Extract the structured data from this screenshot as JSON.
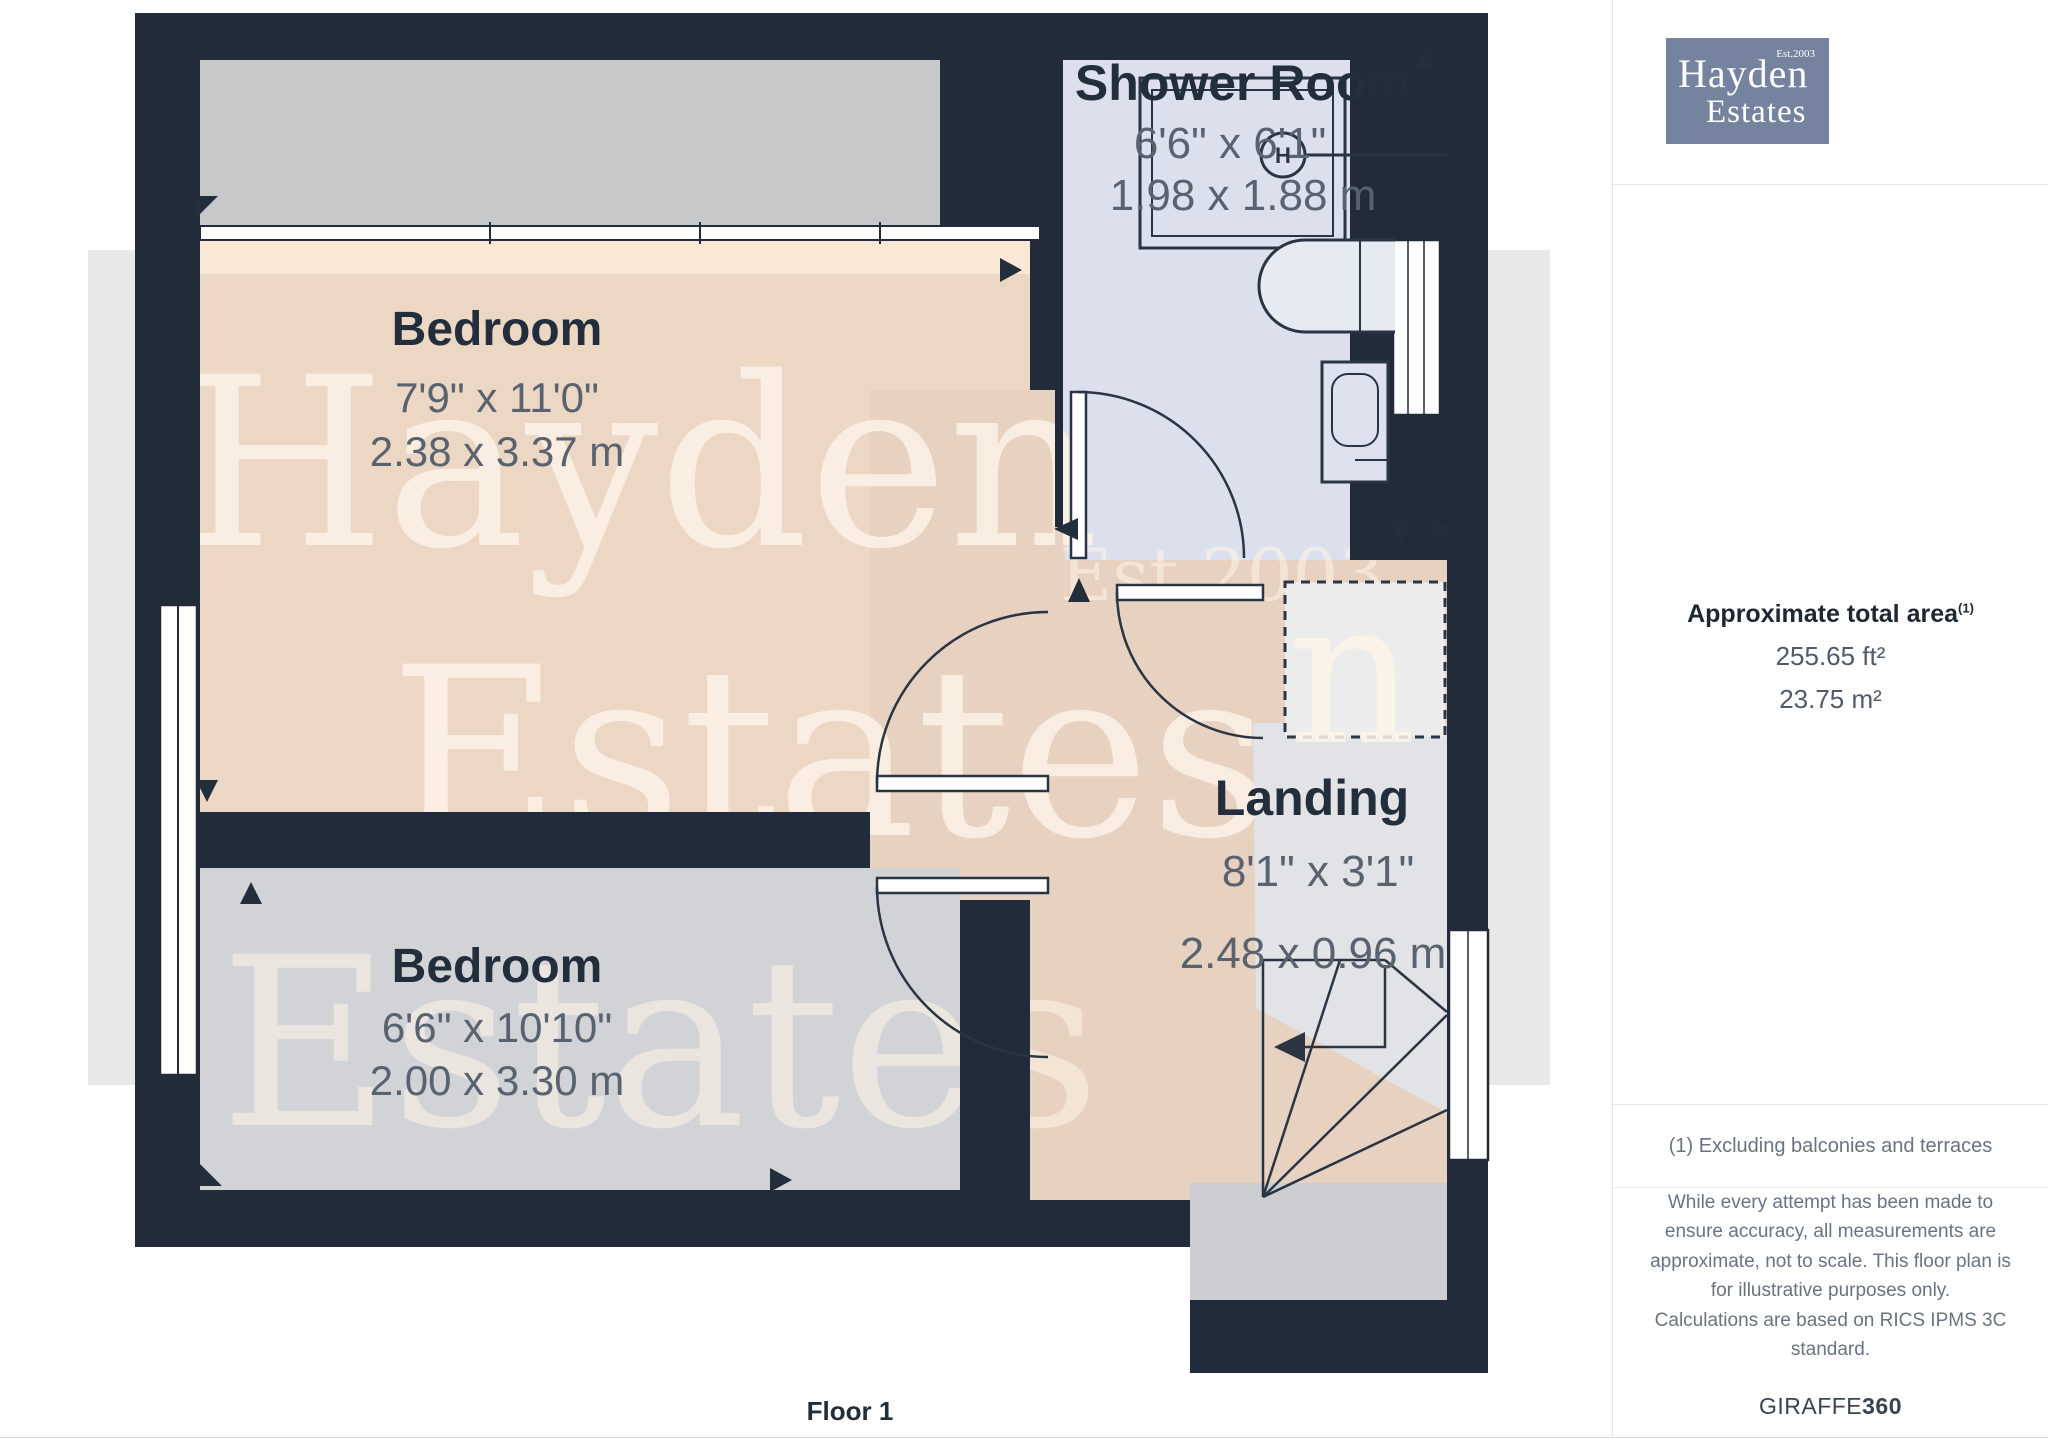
{
  "floor": {
    "label": "Floor 1"
  },
  "rooms": {
    "bedroom1": {
      "name": "Bedroom",
      "imperial": "7'9\" x 11'0\"",
      "metric": "2.38 x 3.37 m"
    },
    "bedroom2": {
      "name": "Bedroom",
      "imperial": "6'6\" x 10'10\"",
      "metric": "2.00 x 3.30 m"
    },
    "shower": {
      "name": "Shower Room",
      "imperial": "6'6\" x 6'1\"",
      "metric": "1.98 x 1.88 m"
    },
    "landing": {
      "name": "Landing",
      "imperial": "8'1\" x 3'1\"",
      "metric": "2.48 x 0.96 m"
    }
  },
  "fixtures": {
    "boiler_symbol": "H"
  },
  "watermark": {
    "line1": "Hayden",
    "line2": "Estates",
    "line3": "Estates",
    "est": "Est.2003"
  },
  "logo": {
    "name1": "Hayden",
    "name2": "Estates",
    "est": "Est.2003"
  },
  "sidebar": {
    "area_title": "Approximate total area",
    "area_superscript": "(1)",
    "area_ft": "255.65 ft²",
    "area_m": "23.75 m²",
    "footnote": "(1) Excluding balconies and terraces",
    "disclaimer1": "While every attempt has been made to ensure accuracy, all measurements are approximate, not to scale. This floor plan is for illustrative purposes only.",
    "disclaimer2": "Calculations are based on RICS IPMS 3C standard.",
    "brand": "GIRAFFE",
    "brand_bold": "360"
  },
  "colors": {
    "wall": "#212b39",
    "bedroom1_floor": "#ecd7c5",
    "bedroom2_floor": "#d2d3d6",
    "shower_floor": "#dbe0ec",
    "landing_floor": "#e7d1c0",
    "eaves": "#c7c8ca",
    "watermark_band": "#e8e8e8",
    "logo_bg": "#75839e"
  }
}
